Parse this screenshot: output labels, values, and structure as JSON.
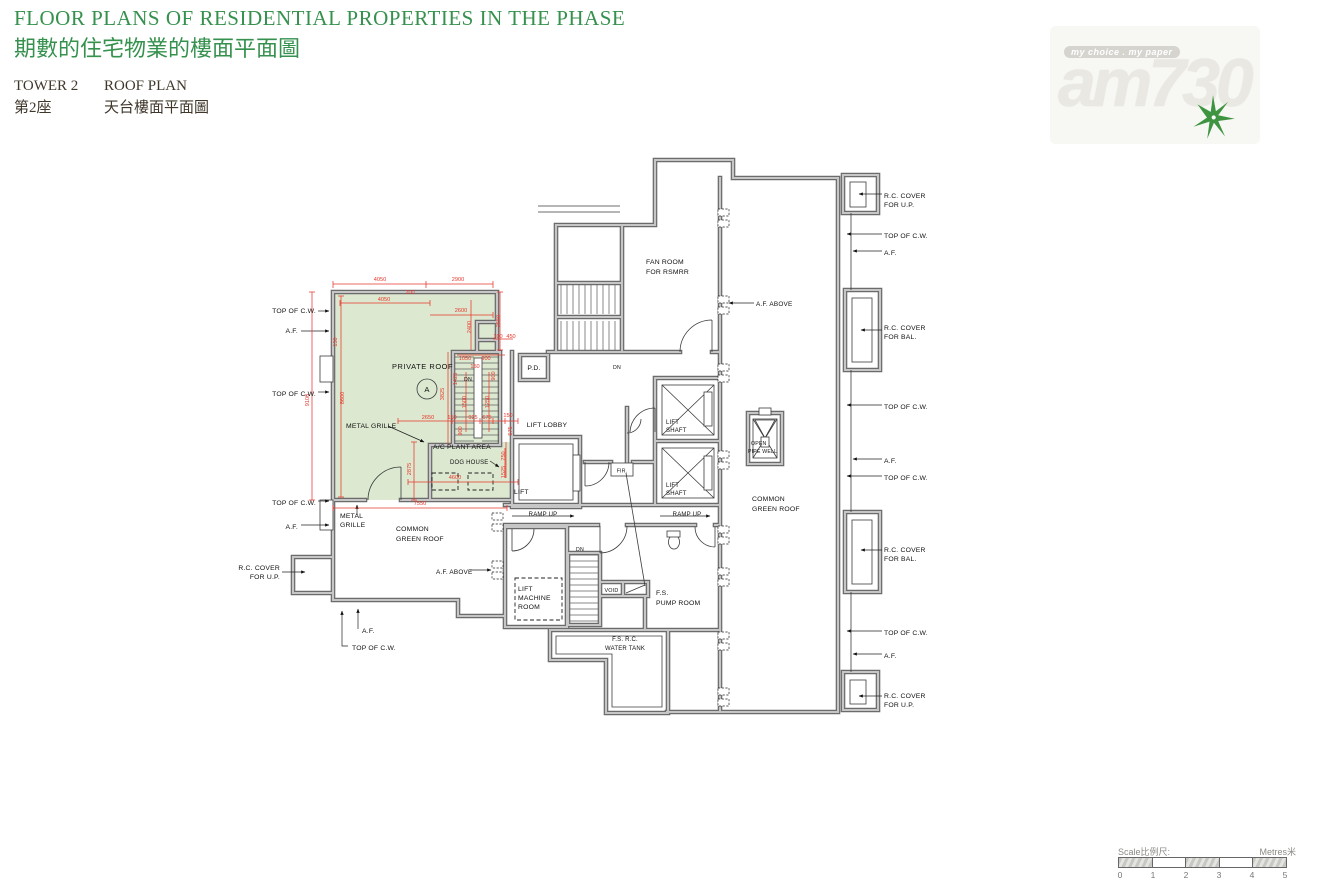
{
  "header": {
    "title_en": "FLOOR PLANS OF RESIDENTIAL PROPERTIES IN THE PHASE",
    "title_zh": "期數的住宅物業的樓面平面圖",
    "tower_en": "TOWER 2",
    "plan_en": "ROOF PLAN",
    "tower_zh": "第2座",
    "plan_zh": "天台樓面平面圖"
  },
  "logo": {
    "tagline": "my choice . my paper",
    "brand": "am730"
  },
  "colors": {
    "title_green": "#35914d",
    "dim_red": "#e8372c",
    "roof_green": "#dce8d0",
    "wall_gray": "#9a9a9a",
    "logo_gray": "#eae8e2",
    "logo_star_green": "#3e9440"
  },
  "plan": {
    "rooms": {
      "private_roof": "PRIVATE ROOF",
      "unit_mark": "A",
      "ac_plant_area": "A/C PLANT AREA",
      "dog_house": "DOG HOUSE",
      "pd": "P.D.",
      "dn": "DN",
      "lift_lobby": "LIFT LOBBY",
      "lift": "LIFT",
      "shaft": "SHAFT",
      "machine": "MACHINE",
      "room": "ROOM",
      "fir": "FIR.",
      "ramp_up": "RAMP UP",
      "open": "OPEN",
      "pipe_well": "PIPE WELL",
      "common": "COMMON",
      "green_roof": "GREEN ROOF",
      "fan_room": "FAN ROOM",
      "for_rsmrr": "FOR RSMRR",
      "void": "VOID",
      "fs": "F.S.",
      "pump_room": "PUMP ROOM",
      "fs_rc": "F.S. R.C.",
      "water_tank": "WATER TANK"
    },
    "annotations": {
      "top_of_cw": "TOP OF C.W.",
      "af": "A.F.",
      "af_above": "A.F. ABOVE",
      "rc_cover": "R.C. COVER",
      "for_up": "FOR U.P.",
      "for_bal": "FOR BAL.",
      "metal_grille": "METAL GRILLE",
      "metal": "METAL",
      "grille": "GRILLE"
    },
    "dims": {
      "v4050": "4050",
      "v2900": "2900",
      "v2600": "2600",
      "v2400": "2400",
      "v2550": "2550",
      "v9100": "9100",
      "v8600": "8600",
      "v3825": "3825",
      "v2650": "2650",
      "v2875": "2875",
      "v4600": "4600",
      "v7550": "7550",
      "v1050": "1050",
      "v1425": "1425",
      "v1500": "1500",
      "v1250": "1250",
      "v925": "925",
      "v675": "675",
      "v575": "575",
      "v900": "900",
      "v750": "750",
      "v1525": "1525",
      "v450": "450",
      "v200": "200",
      "v150": "150",
      "v100": "100"
    }
  },
  "scalebar": {
    "scale_label": "Scale比例尺:",
    "metres_label": "Metres米",
    "ticks": [
      "0",
      "1",
      "2",
      "3",
      "4",
      "5"
    ]
  }
}
